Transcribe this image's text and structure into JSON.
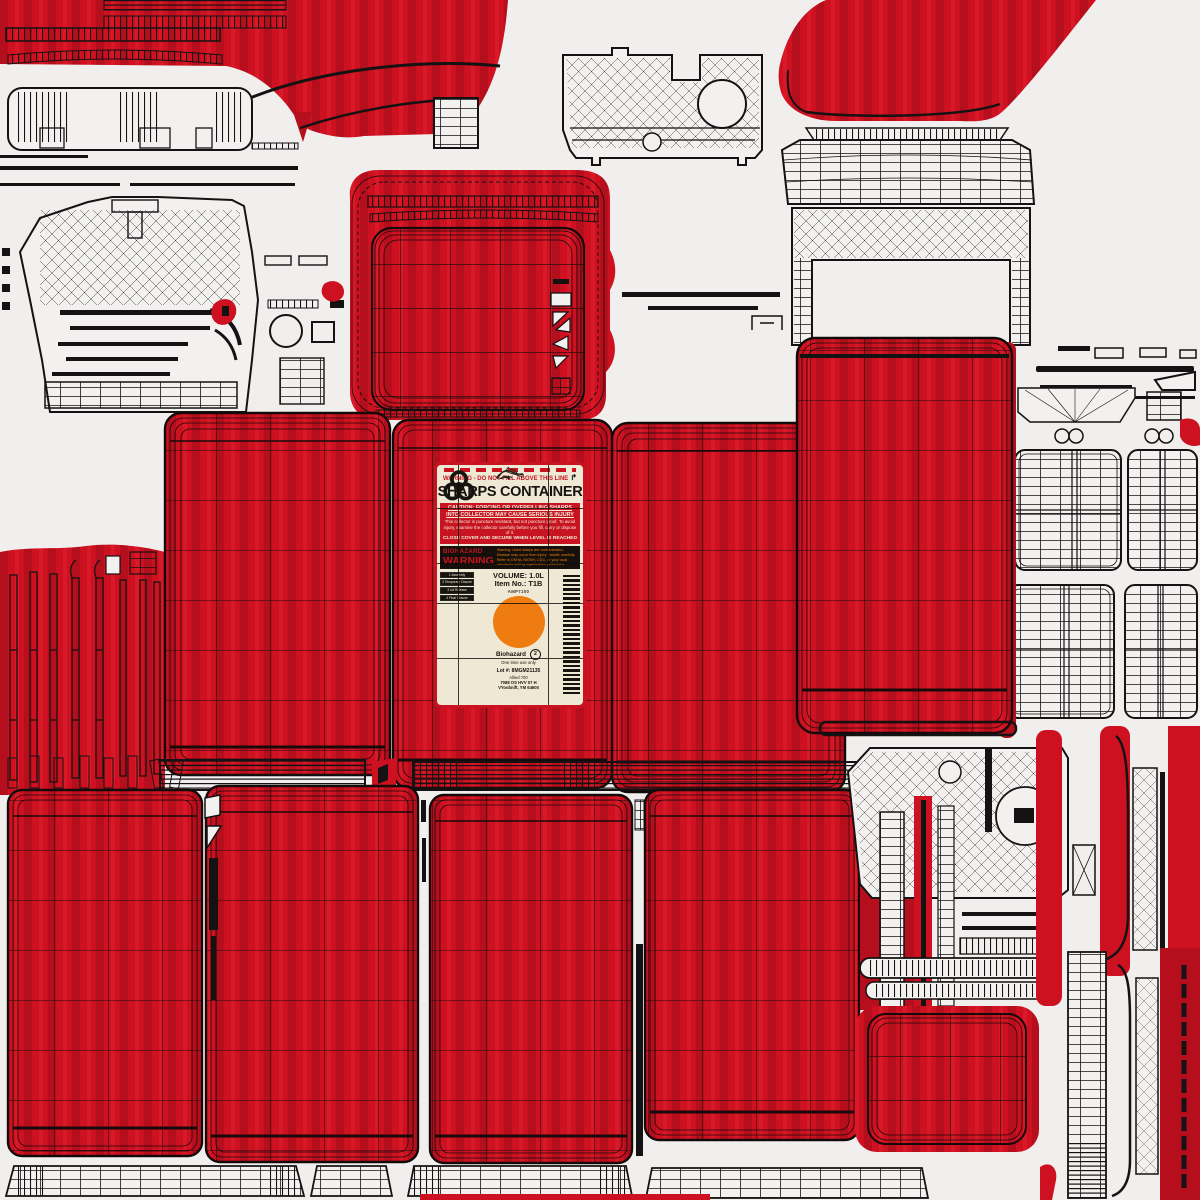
{
  "meta": {
    "asset_type": "uv-texture-atlas",
    "subject": "Sharps container 3D model texture with wireframe overlay"
  },
  "colors": {
    "bg": "#f0efed",
    "red": "#cd1120",
    "red-dark": "#b50e1c",
    "red-bright": "#d81a28",
    "ink": "#141212",
    "label-bg": "#efe8d5",
    "label-red": "#c71420",
    "orange": "#ee7c10",
    "haz-black": "#15100c"
  },
  "label": {
    "top_warning": "WARNING - DO NOT FILL ABOVE THIS LINE",
    "arrow_icon": "↱",
    "title": "SHARPS CONTAINER",
    "caution_heading_1": "CAUTION: FORCING OR OVERFILLING SHARPS",
    "caution_heading_2": "INTO COLLECTOR MAY CAUSE SERIOUS INJURY",
    "caution_body": "This collector is puncture resistant, but not puncture proof. To avoid injury, examine the collector carefully before you fill, carry or dispose of it.",
    "caution_footer": "CLOSE COVER AND SECURE WHEN LEVEL IS REACHED",
    "biohazard_word": "BIOHAZARD",
    "warning_word": "WARNING",
    "hazard_note": "Warning: Used sharps are contaminated. Disease may occur from injury. Handle carefully. Refer to OSHA, NIOSH, CDC, or your local standards setting organization guidelines.",
    "volume": "VOLUME: 1.0L",
    "item_no": "Item No.: T1B",
    "model_code": "AMP7100",
    "biohazard_label": "Biohazard",
    "single_use": "One time use only",
    "resin_code": "2",
    "lot": "Lot #: 8MGM21135",
    "mfr_line1": "Allied 700",
    "mfr_line2": "7088 OS HVV 07 H",
    "mfr_line3": "VYoobnift, YM  64600",
    "steps": [
      {
        "caption": "1 Assembly"
      },
      {
        "caption": "2 Temporary Closure"
      },
      {
        "caption": "3 Lid Release"
      },
      {
        "caption": "4 Final Closure"
      }
    ]
  }
}
